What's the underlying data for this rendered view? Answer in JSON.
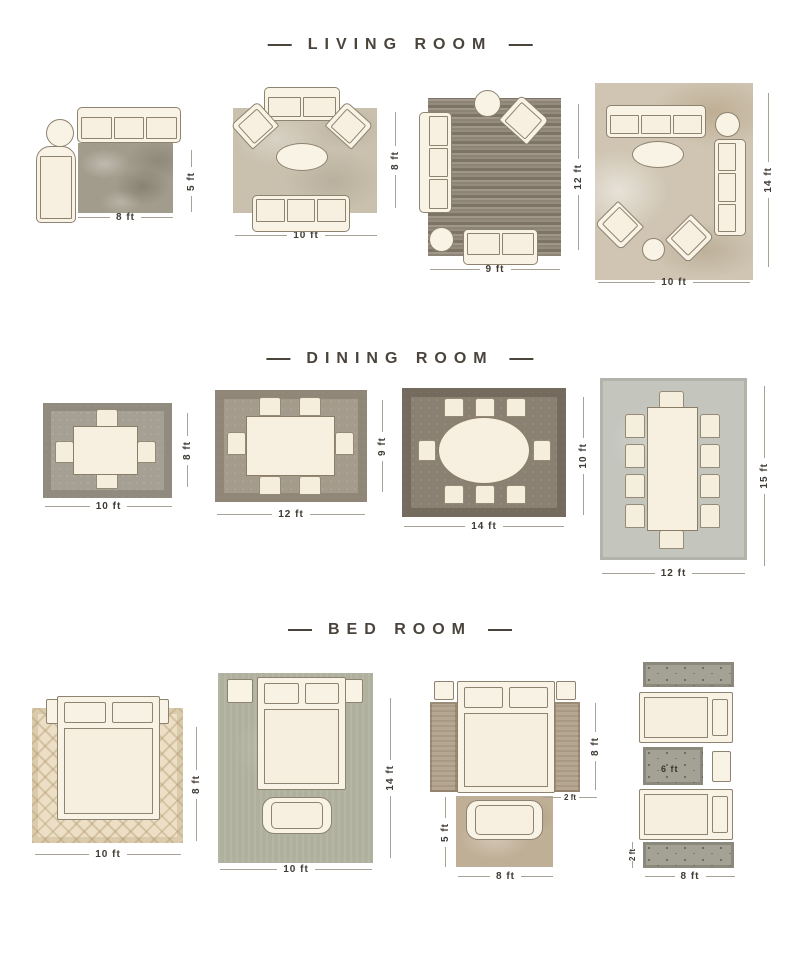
{
  "sections": {
    "living": {
      "title": "LIVING ROOM",
      "layouts": {
        "l1": {
          "width": "8 ft",
          "height": "5 ft"
        },
        "l2": {
          "width": "10 ft",
          "height": "8 ft"
        },
        "l3": {
          "width": "9 ft",
          "height": "12 ft"
        },
        "l4": {
          "width": "10 ft",
          "height": "14 ft"
        }
      }
    },
    "dining": {
      "title": "DINING ROOM",
      "layouts": {
        "l1": {
          "width": "10 ft",
          "height": "8 ft"
        },
        "l2": {
          "width": "12 ft",
          "height": "9 ft"
        },
        "l3": {
          "width": "14 ft",
          "height": "10 ft"
        },
        "l4": {
          "width": "12 ft",
          "height": "15 ft"
        }
      }
    },
    "bedroom": {
      "title": "BED ROOM",
      "layouts": {
        "l1": {
          "width": "10 ft",
          "height": "8 ft"
        },
        "l2": {
          "width": "10 ft",
          "height": "14 ft"
        },
        "l3": {
          "width": "8 ft",
          "side_runner_height": "8 ft",
          "side_runner_width": "2 ft",
          "foot_rug_height": "5 ft"
        },
        "l4": {
          "width": "8 ft",
          "runner_height": "2 ft",
          "between_rug_width": "6 ft"
        }
      }
    }
  },
  "colors": {
    "title_text": "#4a443c",
    "dimension_text": "#3f3a33",
    "furniture_fill": "#f9f3e6",
    "furniture_outline": "#8e8270"
  }
}
